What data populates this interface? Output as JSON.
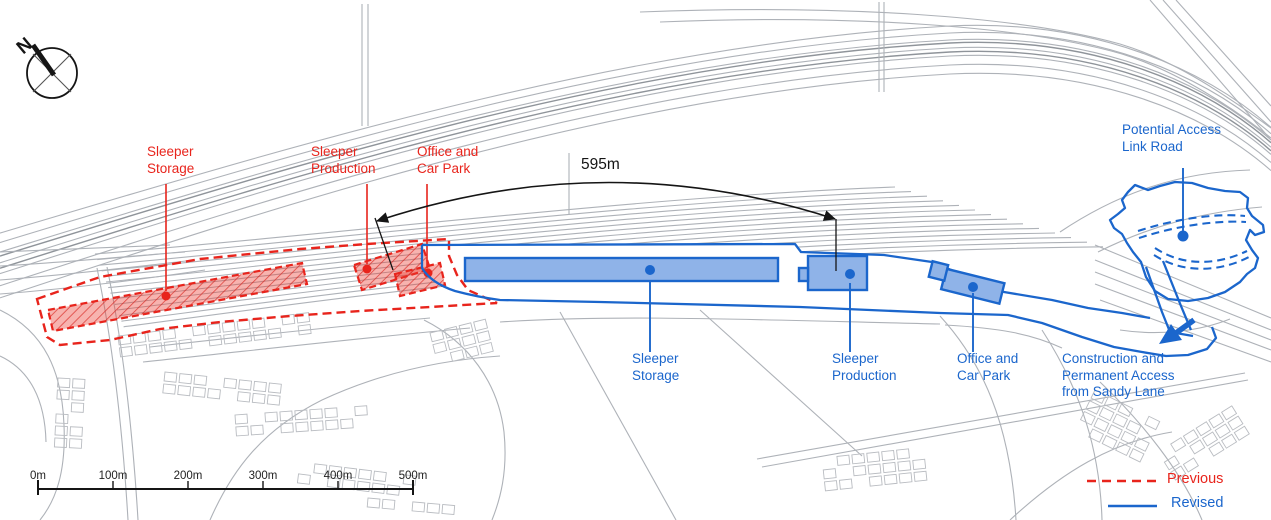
{
  "compass": {
    "north_label": "N"
  },
  "measurement": {
    "label": "595m"
  },
  "previous": {
    "storage": {
      "lines": [
        "Sleeper",
        "Storage"
      ]
    },
    "production": {
      "lines": [
        "Sleeper",
        "Production"
      ]
    },
    "office": {
      "lines": [
        "Office and",
        "Car Park"
      ]
    }
  },
  "revised": {
    "storage": {
      "lines": [
        "Sleeper",
        "Storage"
      ]
    },
    "production": {
      "lines": [
        "Sleeper",
        "Production"
      ]
    },
    "office": {
      "lines": [
        "Office and",
        "Car Park"
      ]
    },
    "access_link_road": {
      "lines": [
        "Potential Access",
        "Link Road"
      ]
    },
    "sandy_lane_access": {
      "lines": [
        "Construction and",
        "Permanent Access",
        "from Sandy Lane"
      ]
    }
  },
  "scalebar": {
    "ticks": [
      "0m",
      "100m",
      "200m",
      "300m",
      "400m",
      "500m"
    ]
  },
  "legend": {
    "items": [
      {
        "label": "Previous",
        "style": "dashed-red"
      },
      {
        "label": "Revised",
        "style": "solid-blue"
      }
    ]
  },
  "colors": {
    "previous_red": "#e8241c",
    "revised_blue": "#1b66cc",
    "revised_fill_blue": "#8fb3e8",
    "linework_gray": "#aeb2b8",
    "linework_gray_dark": "#8f949a",
    "buildings_gray": "#b9bcc1",
    "ink": "#151515"
  }
}
